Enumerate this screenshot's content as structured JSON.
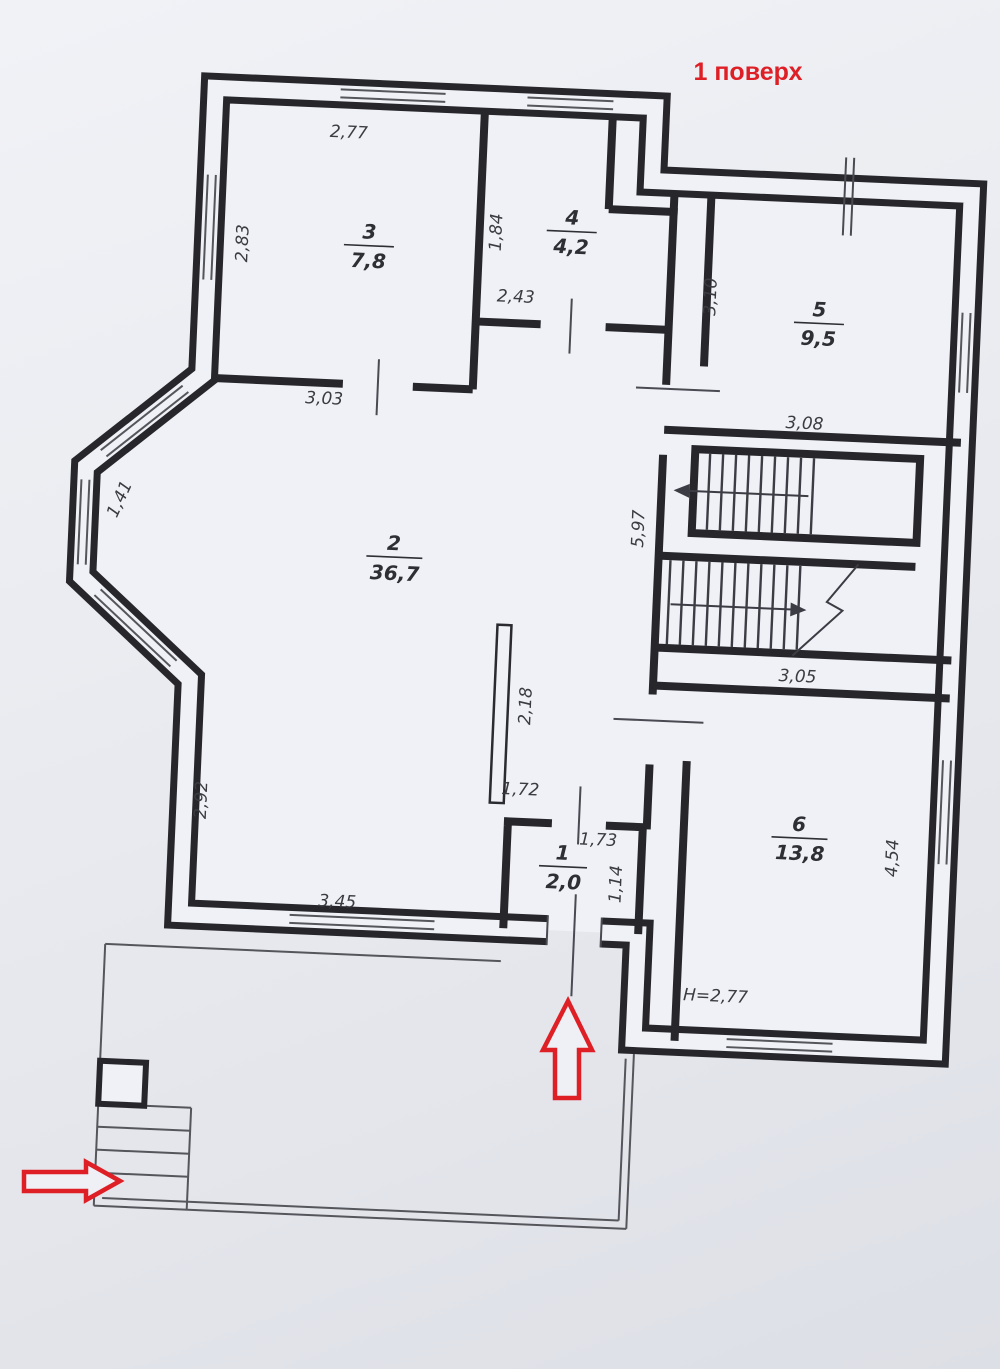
{
  "title": "1 поверх",
  "plan": {
    "rooms": [
      {
        "number": "1",
        "area": "2,0"
      },
      {
        "number": "2",
        "area": "36,7"
      },
      {
        "number": "3",
        "area": "7,8"
      },
      {
        "number": "4",
        "area": "4,2"
      },
      {
        "number": "5",
        "area": "9,5"
      },
      {
        "number": "6",
        "area": "13,8"
      }
    ],
    "dimensions": {
      "room3_top": "2,77",
      "room3_left": "2,83",
      "room3_bottom": "3,03",
      "room4_left": "1,84",
      "room4_bottom": "2,43",
      "room5_left": "3,10",
      "room5_bottom": "3,08",
      "stair_hall_left": "5,97",
      "room6_top": "3,05",
      "room6_right": "4,54",
      "bay_window": "1,41",
      "room2_left": "2,92",
      "room2_bottom": "3,45",
      "room2_partition": "2,18",
      "room1_top": "1,72",
      "room1_upper_right": "1,73",
      "room1_right": "1,14",
      "ceiling_height": "H=2,77"
    }
  },
  "icons": {
    "entrance_arrow_up": "red outlined arrow pointing up at main entrance",
    "entrance_arrow_right": "red outlined arrow pointing right at porch steps"
  },
  "colors": {
    "accent_red": "#df1f26",
    "wall_line": "#26262b",
    "paper": "#eceef3"
  }
}
